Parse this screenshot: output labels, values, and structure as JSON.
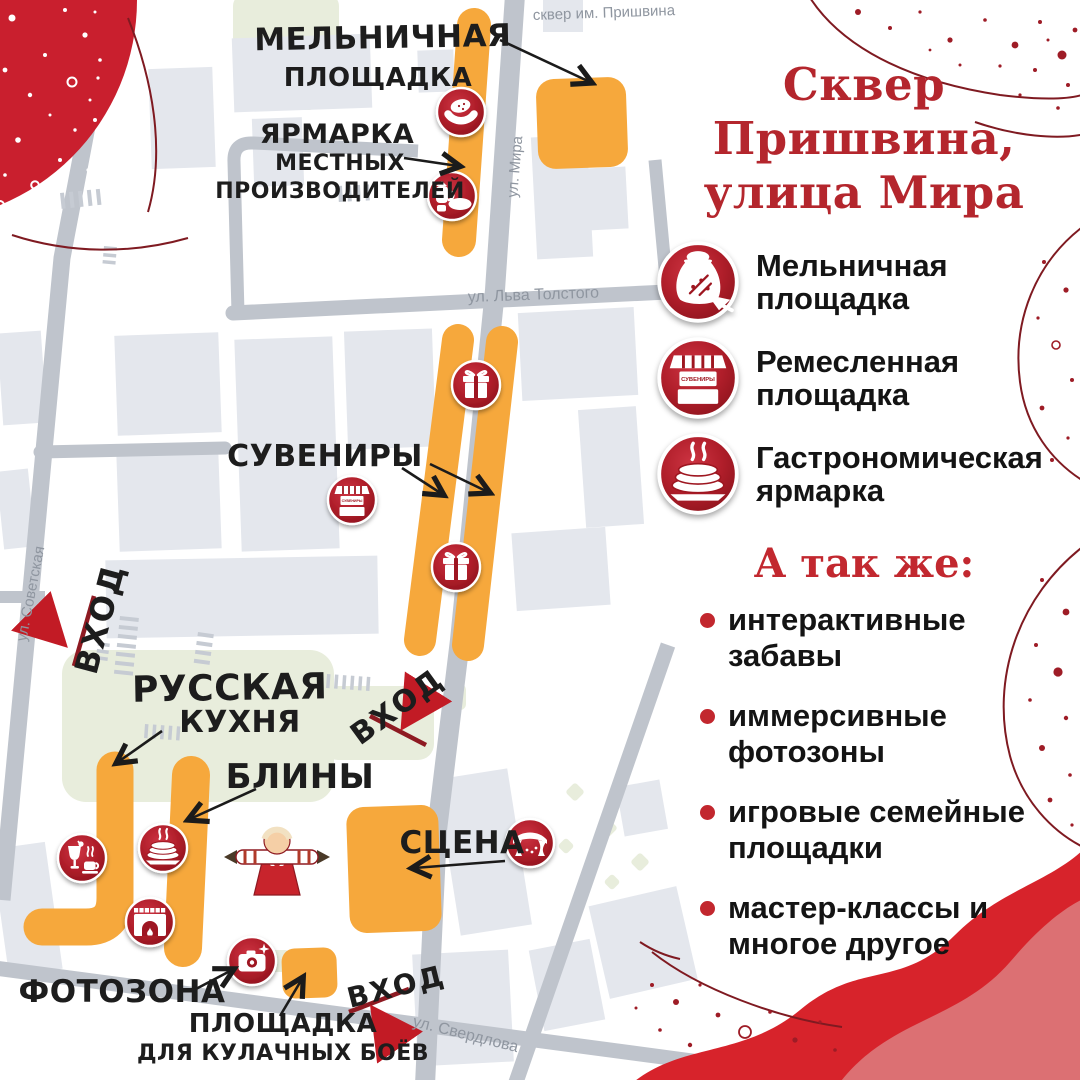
{
  "right_panel": {
    "title_lines": [
      "Сквер",
      "Пришвина,",
      "улица Мира"
    ],
    "legend": [
      {
        "label": "Мельничная площадка",
        "icon": "flour-sack-icon"
      },
      {
        "label": "Ремесленная площадка",
        "icon": "souvenir-stall-icon"
      },
      {
        "label": "Гастрономическая ярмарка",
        "icon": "pancakes-icon"
      }
    ],
    "also_heading": "А так же:",
    "also_items": [
      "интерактивные забавы",
      "иммерсивные фотозоны",
      "игровые семейные площадки",
      "мастер-классы и многое другое"
    ]
  },
  "map": {
    "street_names": {
      "prishvin_park": "сквер им. Пришвина",
      "mira": "ул. Мира",
      "lva_tolstogo": "ул. Льва Толстого",
      "sovetskaya": "ул. Советская",
      "sverdlova": "ул. Свердлова"
    },
    "area_labels": {
      "melnichnaya": [
        "МЕЛЬНИЧНАЯ",
        "ПЛОЩАДКА"
      ],
      "yarmarka": [
        "ЯРМАРКА",
        "МЕСТНЫХ",
        "ПРОИЗВОДИТЕЛЕЙ"
      ],
      "suveniry": "СУВЕНИРЫ",
      "russkaya": [
        "РУССКАЯ",
        "КУХНЯ"
      ],
      "bliny": "БЛИНЫ",
      "scena": "СЦЕНА",
      "fotozona": "ФОТОЗОНА",
      "kulachnye": [
        "ПЛОЩАДКА",
        "ДЛЯ КУЛАЧНЫХ БОЁВ"
      ],
      "vhod": "ВХОД"
    },
    "stall_sign_text": "СУВЕНИРЫ"
  },
  "colors": {
    "title_red": "#B4262D",
    "accent_red": "#C2272E",
    "icon_red_dark": "#8C131C",
    "icon_red": "#B01E2A",
    "zone_orange": "#F6A83C",
    "road_gray": "#BFC4CC",
    "building_gray": "#E4E7ED",
    "green_area": "#E8EDDC",
    "street_label_gray": "#8F96A0",
    "wave_red": "#D7232B",
    "wave_rose": "#DC7073",
    "deco_outline": "#7F1A21"
  }
}
